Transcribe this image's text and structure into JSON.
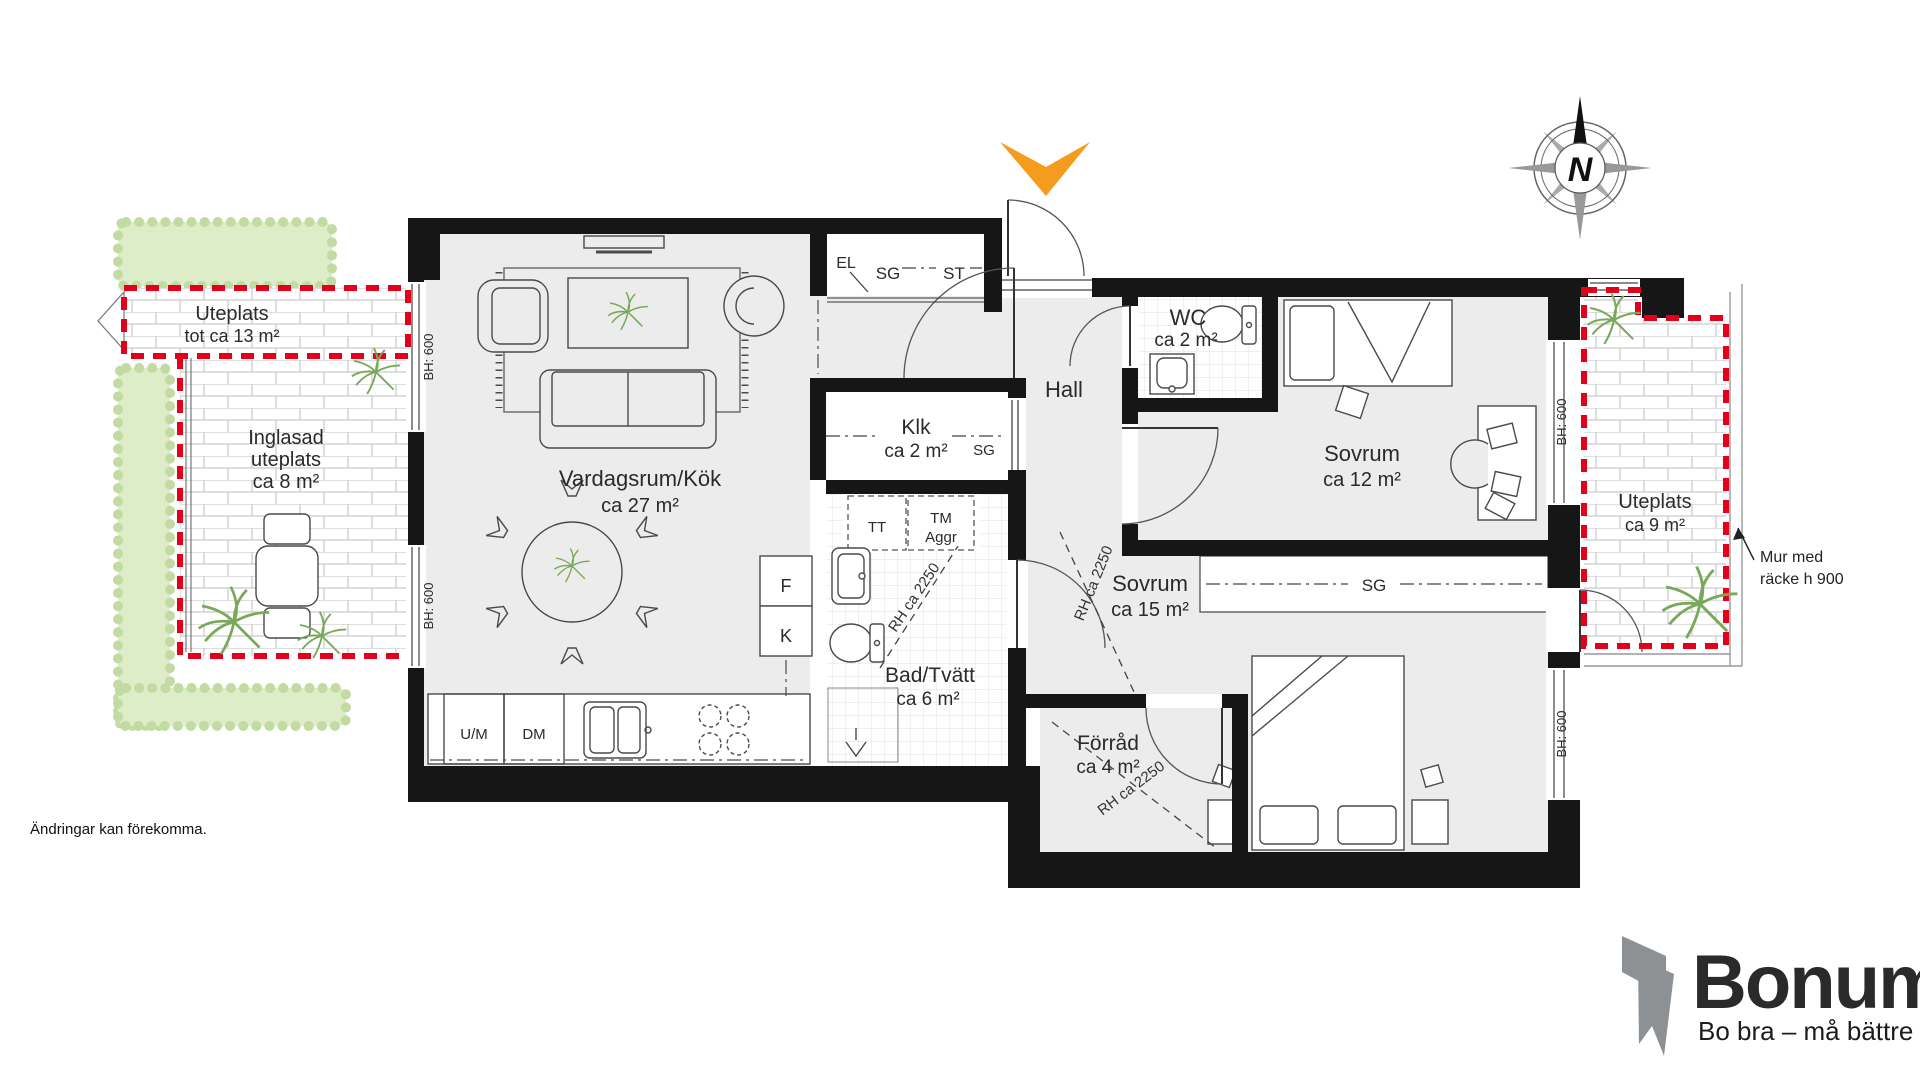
{
  "colors": {
    "accent_red": "#E3001B",
    "accent_orange": "#F59B1E",
    "logo_gray": "#8E9194",
    "hedge_green": "#DCEDC8",
    "wall_black": "#161616",
    "floor_gray": "#ECECEC"
  },
  "rooms": {
    "living": {
      "name": "Vardagsrum/Kök",
      "area": "ca 27 m²"
    },
    "hall": {
      "name": "Hall"
    },
    "wc": {
      "name": "WC",
      "area": "ca 2 m²"
    },
    "bedroom_small": {
      "name": "Sovrum",
      "area": "ca 12 m²"
    },
    "bedroom_large": {
      "name": "Sovrum",
      "area": "ca 15 m²"
    },
    "bath": {
      "name": "Bad/Tvätt",
      "area": "ca 6 m²"
    },
    "storage": {
      "name": "Förråd",
      "area": "ca 4 m²"
    },
    "walkin": {
      "name": "Klk",
      "area": "ca 2 m²"
    }
  },
  "outdoor": {
    "patio_top": {
      "line1": "Uteplats",
      "line2": "tot ca 13 m²"
    },
    "patio_glazed": {
      "line1": "Inglasad",
      "line2": "uteplats",
      "line3": "ca 8 m²"
    },
    "patio_right": {
      "line1": "Uteplats",
      "line2": "ca 9 m²"
    }
  },
  "fixtures": {
    "el": "EL",
    "sg": "SG",
    "st": "ST",
    "tt": "TT",
    "tm": "TM",
    "aggr": "Aggr",
    "fridge": "F",
    "freezer": "K",
    "um": "U/M",
    "dm": "DM"
  },
  "dims": {
    "bh": "BH: 600",
    "rh": "RH ca 2250"
  },
  "annotations": {
    "mur_line1": "Mur med",
    "mur_line2": "räcke h 900",
    "disclaimer": "Ändringar kan förekomma.",
    "north": "N"
  },
  "logo": {
    "brand": "Bonum",
    "tagline": "Bo bra – må bättre"
  }
}
